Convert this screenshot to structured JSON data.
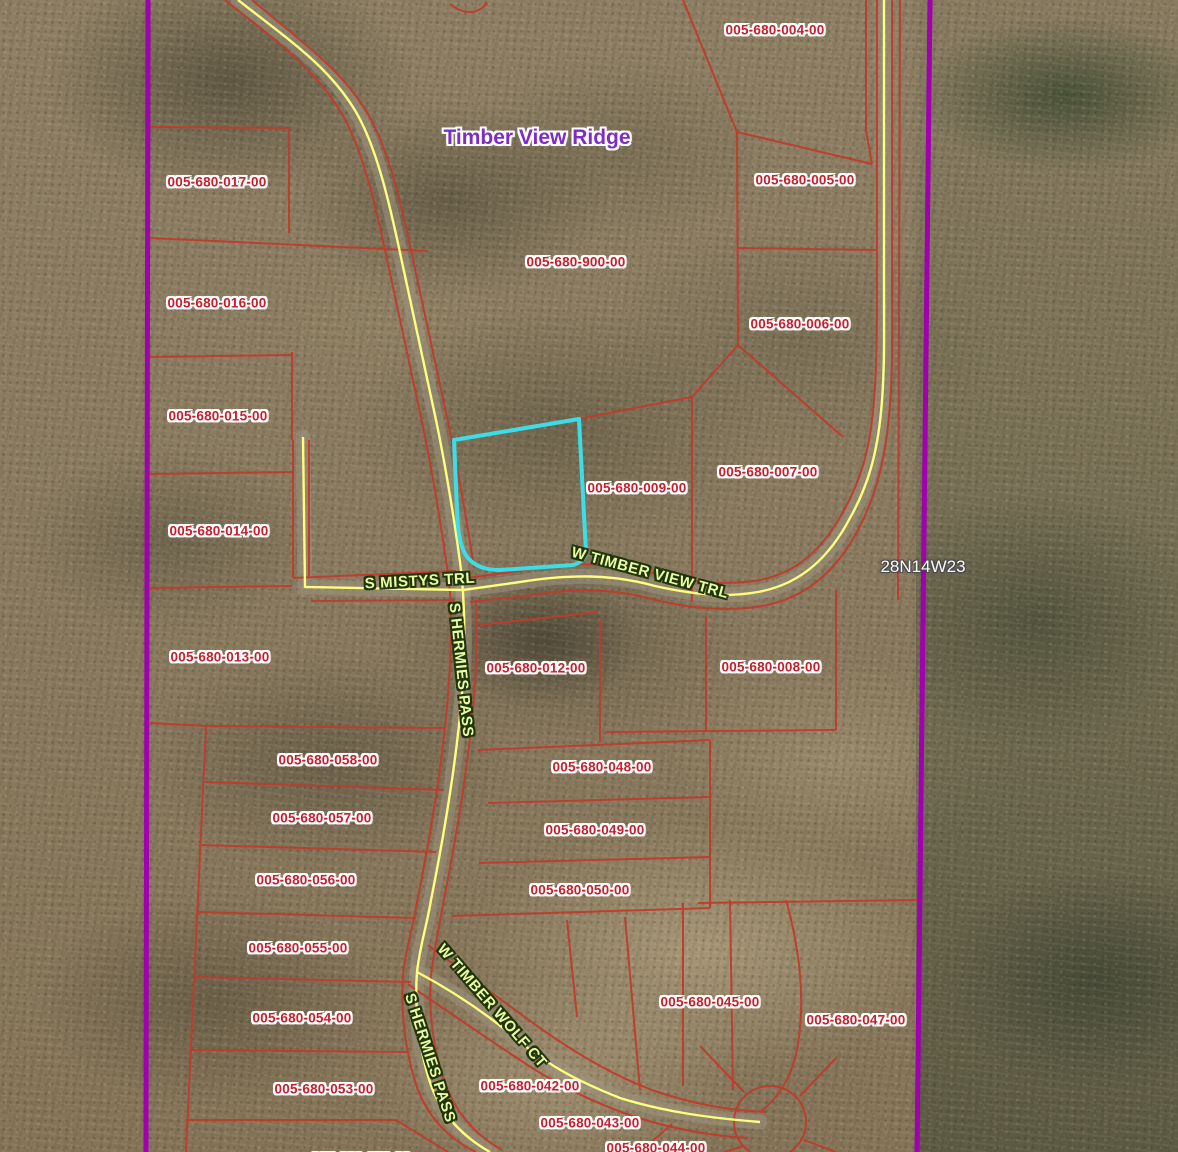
{
  "map": {
    "subdivision_label": {
      "text": "Timber View Ridge",
      "x": 537,
      "y": 138
    },
    "section_label": {
      "text": "28N14W23",
      "x": 923,
      "y": 567
    },
    "parcel_labels": [
      {
        "text": "005-680-004-00",
        "x": 775,
        "y": 30
      },
      {
        "text": "005-680-017-00",
        "x": 217,
        "y": 182
      },
      {
        "text": "005-680-005-00",
        "x": 805,
        "y": 180
      },
      {
        "text": "005-680-900-00",
        "x": 576,
        "y": 262
      },
      {
        "text": "005-680-016-00",
        "x": 217,
        "y": 303
      },
      {
        "text": "005-680-006-00",
        "x": 800,
        "y": 324
      },
      {
        "text": "005-680-015-00",
        "x": 218,
        "y": 416
      },
      {
        "text": "005-680-007-00",
        "x": 768,
        "y": 472
      },
      {
        "text": "005-680-009-00",
        "x": 637,
        "y": 488
      },
      {
        "text": "005-680-014-00",
        "x": 219,
        "y": 531
      },
      {
        "text": "005-680-013-00",
        "x": 220,
        "y": 657
      },
      {
        "text": "005-680-012-00",
        "x": 536,
        "y": 668
      },
      {
        "text": "005-680-008-00",
        "x": 771,
        "y": 667
      },
      {
        "text": "005-680-058-00",
        "x": 328,
        "y": 760
      },
      {
        "text": "005-680-048-00",
        "x": 602,
        "y": 767
      },
      {
        "text": "005-680-057-00",
        "x": 322,
        "y": 818
      },
      {
        "text": "005-680-049-00",
        "x": 595,
        "y": 830
      },
      {
        "text": "005-680-056-00",
        "x": 306,
        "y": 880
      },
      {
        "text": "005-680-050-00",
        "x": 580,
        "y": 890
      },
      {
        "text": "005-680-055-00",
        "x": 298,
        "y": 948
      },
      {
        "text": "005-680-054-00",
        "x": 302,
        "y": 1018
      },
      {
        "text": "005-680-045-00",
        "x": 710,
        "y": 1002
      },
      {
        "text": "005-680-047-00",
        "x": 856,
        "y": 1020
      },
      {
        "text": "005-680-053-00",
        "x": 324,
        "y": 1089
      },
      {
        "text": "005-680-042-00",
        "x": 530,
        "y": 1086
      },
      {
        "text": "005-680-043-00",
        "x": 590,
        "y": 1123
      },
      {
        "text": "005-680-044-00",
        "x": 656,
        "y": 1148
      },
      {
        "text": "005-680-052-00",
        "x": 361,
        "y": 1158
      }
    ],
    "road_labels": [
      {
        "text": "S MISTYS TRL",
        "x": 420,
        "y": 581,
        "rotation": -3
      },
      {
        "text": "S HERMIES PASS",
        "x": 461,
        "y": 670,
        "rotation": 84
      },
      {
        "text": "W TIMBER VIEW TRL",
        "x": 650,
        "y": 573,
        "rotation": 15
      },
      {
        "text": "W TIMBER WOLF CT",
        "x": 492,
        "y": 1006,
        "rotation": 49
      },
      {
        "text": "S HERMIES PASS",
        "x": 430,
        "y": 1058,
        "rotation": 72
      }
    ],
    "colors": {
      "parcel_label_text": "#c5202e",
      "parcel_label_halo": "#ffffff",
      "road_label_text": "#e9fca4",
      "road_label_outline": "#20350a",
      "subdivision_text": "#7d2cc4",
      "section_text": "#fafafa",
      "parcel_line": "#c23a2b",
      "road_line": "#fdff7d",
      "boundary_line": "#a000b0",
      "selected_parcel_outline": "#3bdde9"
    }
  }
}
